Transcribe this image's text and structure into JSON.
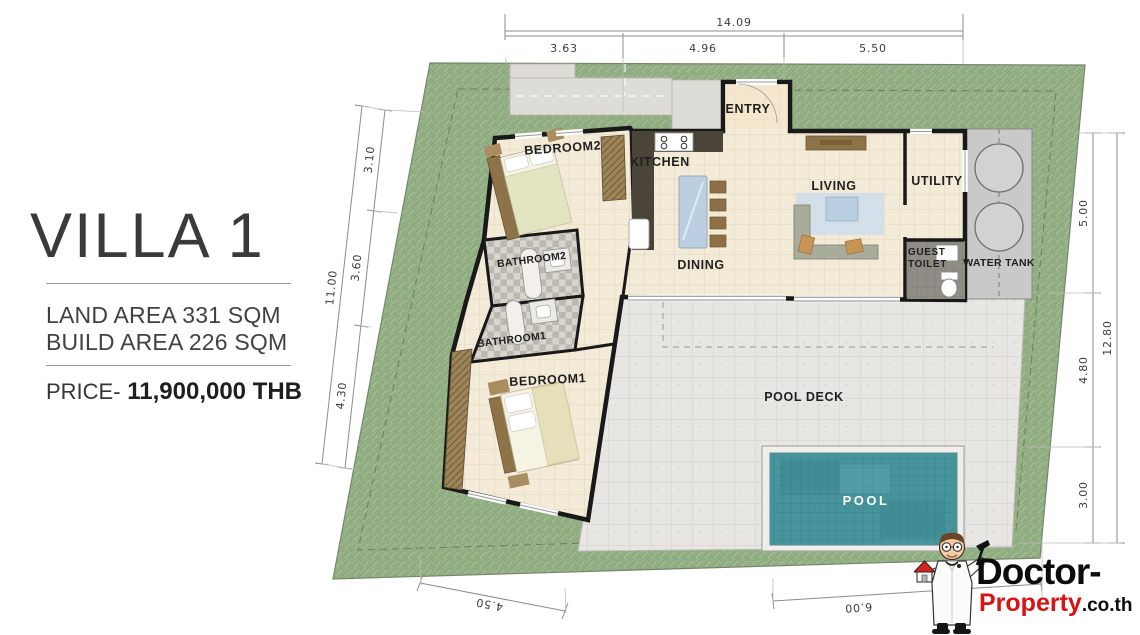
{
  "title_panel": {
    "title": "VILLA 1",
    "land_area": "LAND AREA 331 SQM",
    "build_area": "BUILD AREA 226 SQM",
    "price_label": "PRICE-",
    "price_value": " 11,900,000 THB"
  },
  "rooms": {
    "entry": "ENTRY",
    "kitchen": "KITCHEN",
    "dining": "DINING",
    "living": "LIVING",
    "utility": "UTILITY",
    "guest_toilet_line1": "GUEST",
    "guest_toilet_line2": "TOILET",
    "water_tank": "WATER TANK",
    "bedroom1": "BEDROOM1",
    "bedroom2": "BEDROOM2",
    "bathroom1": "BATHROOM1",
    "bathroom2": "BATHROOM2",
    "pool": "POOL",
    "pool_deck": "POOL DECK"
  },
  "dimensions": {
    "top": {
      "total": "14.09",
      "segments": [
        "3.63",
        "4.96",
        "5.50"
      ]
    },
    "left": {
      "total": "11.00",
      "segments": [
        "3.10",
        "3.60",
        "4.30"
      ]
    },
    "right": {
      "total": "12.80",
      "segments": [
        "5.00",
        "4.80",
        "3.00"
      ]
    },
    "bottom": {
      "segments": [
        "4.50",
        "6.00"
      ]
    }
  },
  "logo": {
    "brand": "Doctor-",
    "brand_red": "Property",
    "brand_suffix": ".co.th"
  },
  "colors": {
    "grass": "#97b288",
    "floor": "#f3ebd8",
    "deck": "#e8e6e2",
    "pool_water": "#47949d",
    "wall": "#191919",
    "logo_red": "#d91212"
  }
}
